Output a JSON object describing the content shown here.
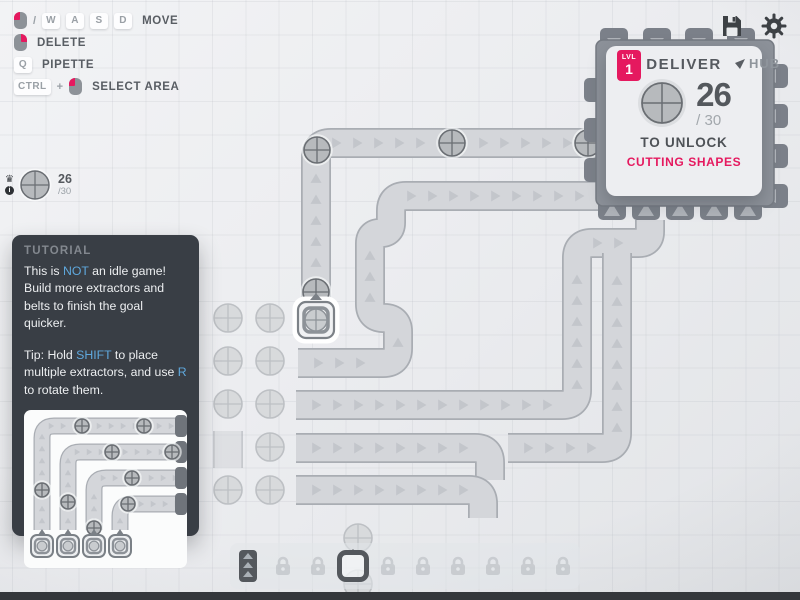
{
  "colors": {
    "accent_pink": "#e5195f",
    "keyword_blue": "#5fa8dd",
    "panel_dark": "#393e45"
  },
  "keybindings": {
    "rows": [
      {
        "label": "MOVE"
      },
      {
        "label": "DELETE"
      },
      {
        "label": "PIPETTE"
      },
      {
        "label": "SELECT AREA"
      }
    ],
    "keys": {
      "move": [
        "W",
        "A",
        "S",
        "D"
      ],
      "pipette": "Q",
      "ctrl": "CTRL"
    },
    "separators": {
      "slash": "/",
      "plus": "+"
    }
  },
  "topbar": {
    "save_icon": "floppy-disk",
    "settings_icon": "gear"
  },
  "hub_panel": {
    "level_label": "LVL",
    "level": "1",
    "title": "DELIVER",
    "amount": "26",
    "goal": "/ 30",
    "unlock_text": "TO UNLOCK",
    "reward": "CUTTING SHAPES",
    "hub_label": "HUB",
    "deliver_shape": "circle"
  },
  "pinned_goal": {
    "amount": "26",
    "goal": "/30",
    "shape": "circle"
  },
  "tutorial": {
    "title": "TUTORIAL",
    "p1": [
      {
        "t": "This is "
      },
      {
        "t": "NOT",
        "hl": true
      },
      {
        "t": " an idle game! Build more extractors and belts to finish the goal quicker."
      }
    ],
    "p2": [
      {
        "t": "Tip: Hold "
      },
      {
        "t": "SHIFT",
        "hl": true
      },
      {
        "t": " to place multiple extractors, and use "
      },
      {
        "t": "R",
        "hl": true
      },
      {
        "t": " to rotate them."
      }
    ]
  },
  "toolbar": {
    "items": [
      {
        "type": "belt",
        "state": "available"
      },
      {
        "type": "locked",
        "state": "locked"
      },
      {
        "type": "locked",
        "state": "locked"
      },
      {
        "type": "extractor",
        "state": "selected"
      },
      {
        "type": "locked",
        "state": "locked"
      },
      {
        "type": "locked",
        "state": "locked"
      },
      {
        "type": "locked",
        "state": "locked"
      },
      {
        "type": "locked",
        "state": "locked"
      },
      {
        "type": "locked",
        "state": "locked"
      },
      {
        "type": "locked",
        "state": "locked"
      }
    ]
  },
  "map": {
    "resource_shape": "circle",
    "belt_item_shape": "circle"
  }
}
